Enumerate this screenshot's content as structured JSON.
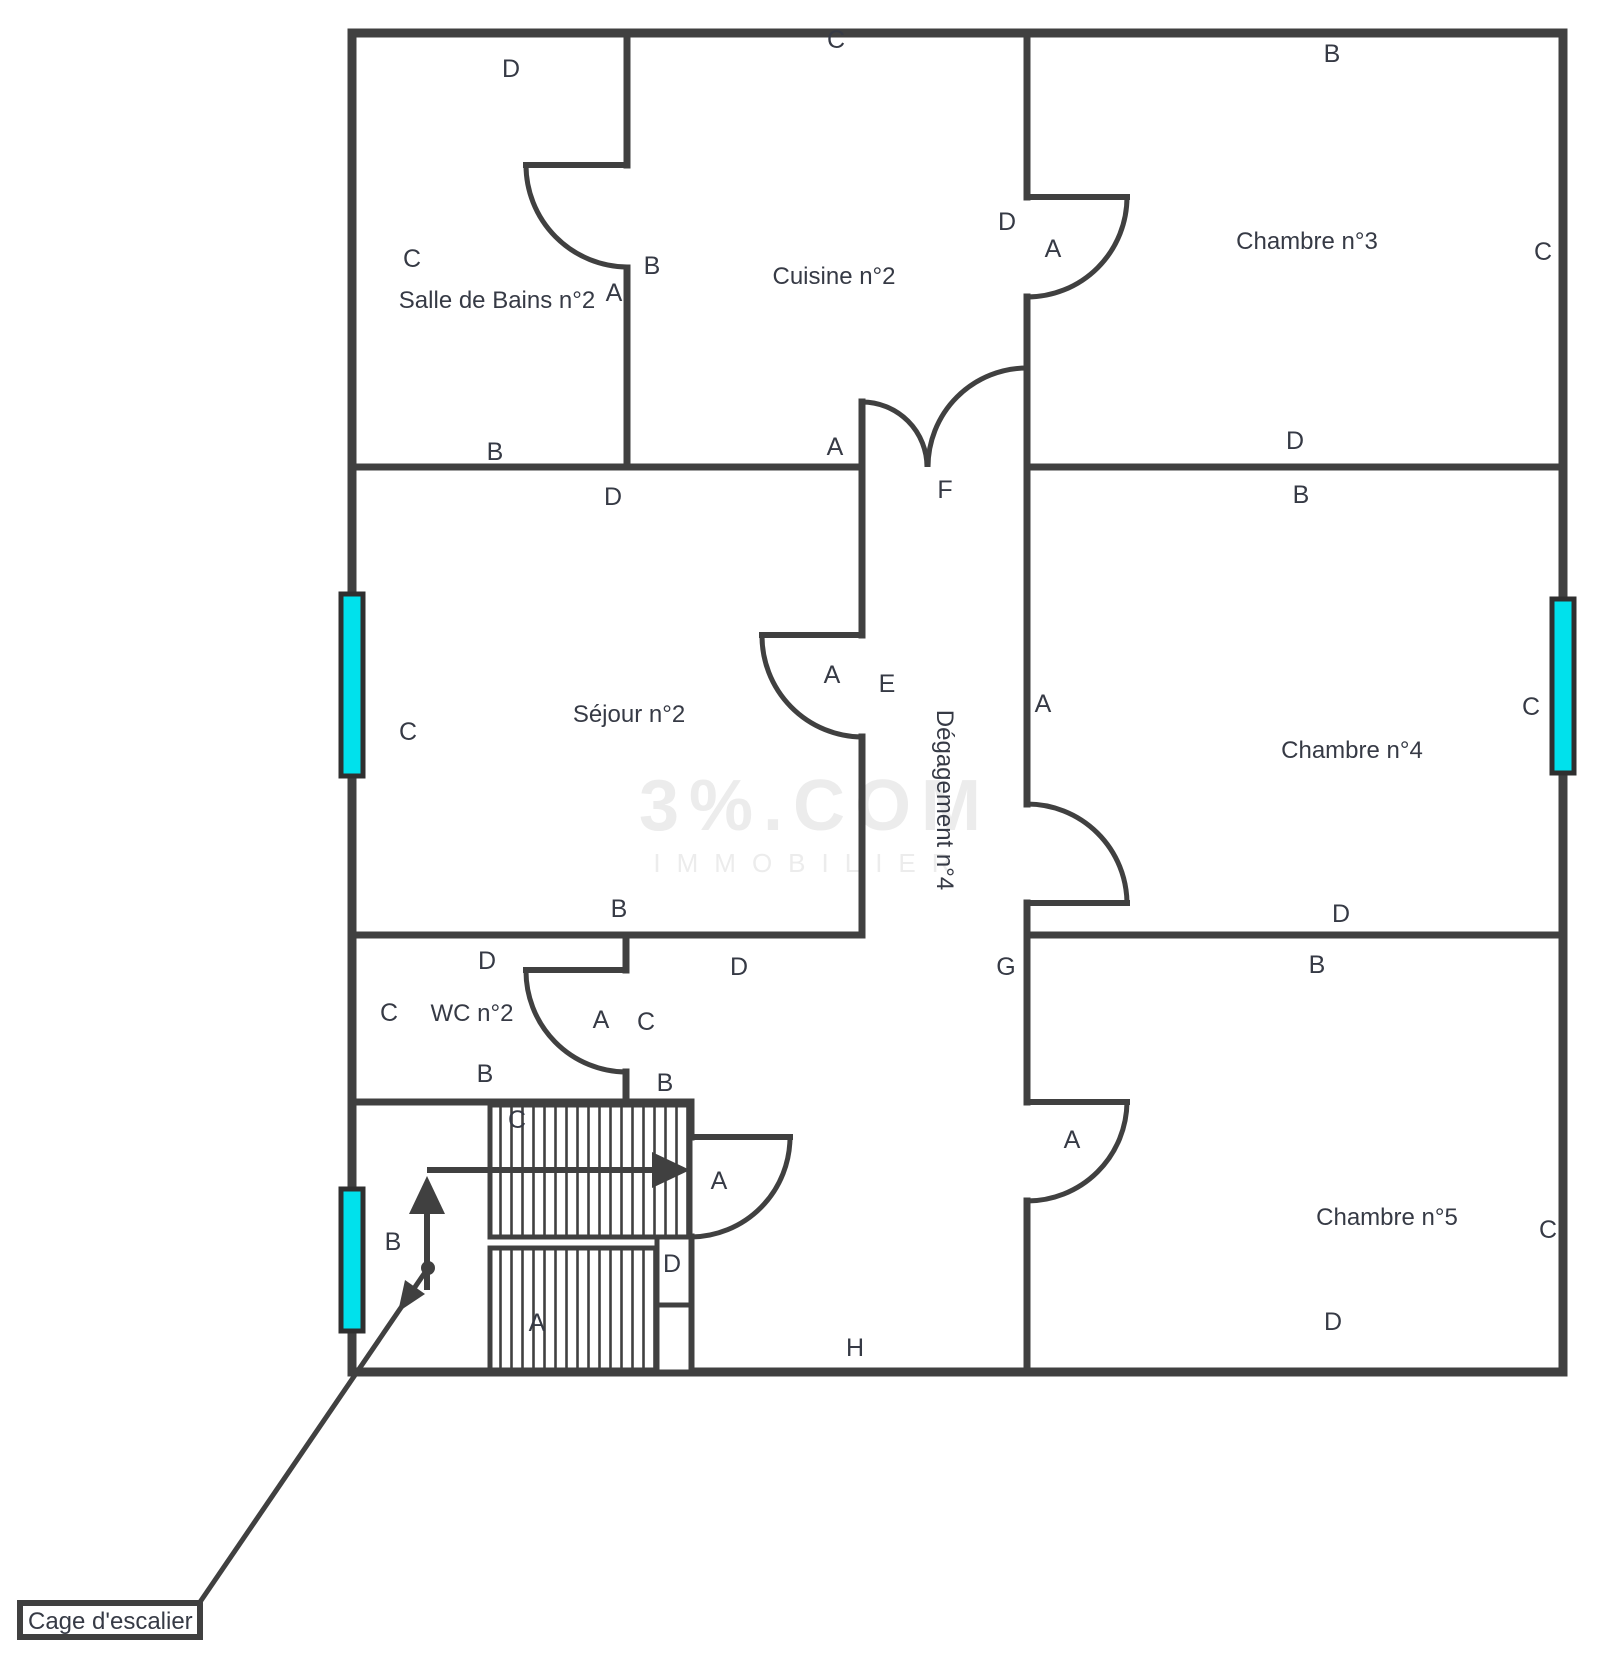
{
  "rooms": [
    {
      "id": "salle-de-bains-2",
      "name": "Salle de Bains n°2",
      "x": 497,
      "y": 308
    },
    {
      "id": "cuisine-2",
      "name": "Cuisine n°2",
      "x": 834,
      "y": 284
    },
    {
      "id": "chambre-3",
      "name": "Chambre n°3",
      "x": 1307,
      "y": 249
    },
    {
      "id": "sejour-2",
      "name": "Séjour n°2",
      "x": 629,
      "y": 722
    },
    {
      "id": "degagement-4",
      "name": "Dégagement n°4",
      "x": 937,
      "y": 800,
      "rotate": 90
    },
    {
      "id": "chambre-4",
      "name": "Chambre n°4",
      "x": 1352,
      "y": 758
    },
    {
      "id": "wc-2",
      "name": "WC n°2",
      "x": 472,
      "y": 1021
    },
    {
      "id": "chambre-5",
      "name": "Chambre n°5",
      "x": 1387,
      "y": 1225
    }
  ],
  "stairwell": {
    "label": "Cage d'escalier"
  },
  "wall_labels": [
    {
      "t": "D",
      "x": 511,
      "y": 77
    },
    {
      "t": "C",
      "x": 836,
      "y": 48
    },
    {
      "t": "B",
      "x": 1332,
      "y": 62
    },
    {
      "t": "C",
      "x": 412,
      "y": 267
    },
    {
      "t": "B",
      "x": 652,
      "y": 274
    },
    {
      "t": "A",
      "x": 614,
      "y": 301
    },
    {
      "t": "D",
      "x": 1007,
      "y": 230
    },
    {
      "t": "A",
      "x": 1053,
      "y": 257
    },
    {
      "t": "C",
      "x": 1543,
      "y": 260
    },
    {
      "t": "B",
      "x": 495,
      "y": 460
    },
    {
      "t": "A",
      "x": 835,
      "y": 455
    },
    {
      "t": "D",
      "x": 1295,
      "y": 449
    },
    {
      "t": "D",
      "x": 613,
      "y": 505
    },
    {
      "t": "F",
      "x": 945,
      "y": 498
    },
    {
      "t": "B",
      "x": 1301,
      "y": 503
    },
    {
      "t": "C",
      "x": 408,
      "y": 740
    },
    {
      "t": "A",
      "x": 832,
      "y": 683
    },
    {
      "t": "E",
      "x": 887,
      "y": 692
    },
    {
      "t": "A",
      "x": 1043,
      "y": 712
    },
    {
      "t": "C",
      "x": 1531,
      "y": 715
    },
    {
      "t": "B",
      "x": 619,
      "y": 917
    },
    {
      "t": "D",
      "x": 1341,
      "y": 922
    },
    {
      "t": "D",
      "x": 487,
      "y": 969
    },
    {
      "t": "D",
      "x": 739,
      "y": 975
    },
    {
      "t": "G",
      "x": 1006,
      "y": 975
    },
    {
      "t": "B",
      "x": 1317,
      "y": 973
    },
    {
      "t": "C",
      "x": 389,
      "y": 1021
    },
    {
      "t": "A",
      "x": 601,
      "y": 1028
    },
    {
      "t": "C",
      "x": 646,
      "y": 1030
    },
    {
      "t": "B",
      "x": 485,
      "y": 1082
    },
    {
      "t": "B",
      "x": 665,
      "y": 1091
    },
    {
      "t": "C",
      "x": 517,
      "y": 1128
    },
    {
      "t": "B",
      "x": 393,
      "y": 1250
    },
    {
      "t": "A",
      "x": 719,
      "y": 1189
    },
    {
      "t": "D",
      "x": 672,
      "y": 1272
    },
    {
      "t": "A",
      "x": 537,
      "y": 1331
    },
    {
      "t": "H",
      "x": 855,
      "y": 1356
    },
    {
      "t": "A",
      "x": 1072,
      "y": 1148
    },
    {
      "t": "C",
      "x": 1548,
      "y": 1238
    },
    {
      "t": "D",
      "x": 1333,
      "y": 1330
    }
  ],
  "watermark": {
    "line1": "3%.COM",
    "line2": "IMMOBILIER"
  },
  "colors": {
    "wall": "#404040",
    "window_fill": "#00e1ec",
    "window_frame": "#2f2f2f",
    "label": "#363a45",
    "watermark": "#ececec",
    "background": "#ffffff"
  }
}
